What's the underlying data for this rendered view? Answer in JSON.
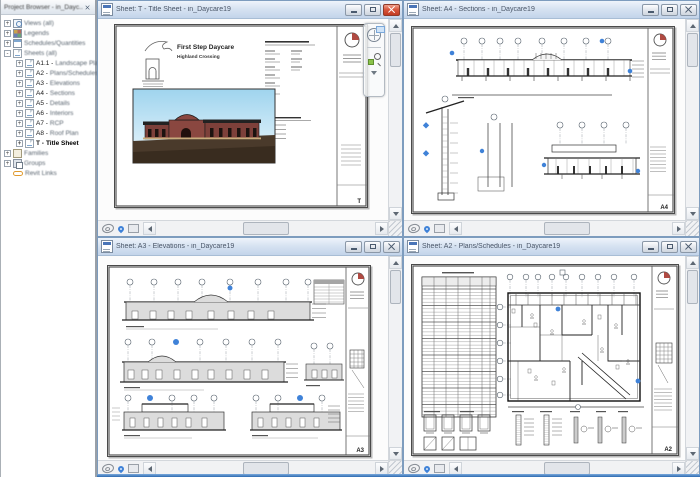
{
  "browser": {
    "title": "Project Browser - in_Dayc...",
    "items": [
      {
        "expander": "+",
        "label": "Views (all)"
      },
      {
        "expander": "+",
        "label": "Legends"
      },
      {
        "expander": "+",
        "label": "Schedules/Quantities"
      },
      {
        "expander": "-",
        "label": "Sheets (all)"
      },
      {
        "expander": "+",
        "num": "A1.1 -",
        "name": "Landscape Plan"
      },
      {
        "expander": "+",
        "num": "A2 -",
        "name": "Plans/Schedules"
      },
      {
        "expander": "+",
        "num": "A3 -",
        "name": "Elevations"
      },
      {
        "expander": "+",
        "num": "A4 -",
        "name": "Sections"
      },
      {
        "expander": "+",
        "num": "A5 -",
        "name": "Details"
      },
      {
        "expander": "+",
        "num": "A6 -",
        "name": "Interiors"
      },
      {
        "expander": "+",
        "num": "A7 -",
        "name": "RCP"
      },
      {
        "expander": "+",
        "num": "A8 -",
        "name": "Roof Plan"
      },
      {
        "expander": "+",
        "num": "T -",
        "name": "Title Sheet"
      },
      {
        "expander": "+",
        "label": "Families"
      },
      {
        "expander": "+",
        "label": "Groups"
      },
      {
        "label": "Revit Links"
      }
    ]
  },
  "windows": [
    {
      "title": "Sheet: T - Title Sheet - in_Daycare19",
      "sheet_number": "T"
    },
    {
      "title": "Sheet: A4 - Sections - in_Daycare19",
      "sheet_number": "A4"
    },
    {
      "title": "Sheet: A3 - Elevations - in_Daycare19",
      "sheet_number": "A3"
    },
    {
      "title": "Sheet: A2 - Plans/Schedules - in_Daycare19",
      "sheet_number": "A2"
    }
  ],
  "title_sheet": {
    "project_name": "First Step Daycare",
    "project_subtitle": "Highland Crossing"
  },
  "colors": {
    "accent_blue": "#3f82d8",
    "logo_red": "#b04a42",
    "sky_top": "#9fd4ee",
    "building_red": "#8a4740",
    "ground_brown": "#4a3a2b",
    "elevation_gray": "#dcdcdc"
  }
}
